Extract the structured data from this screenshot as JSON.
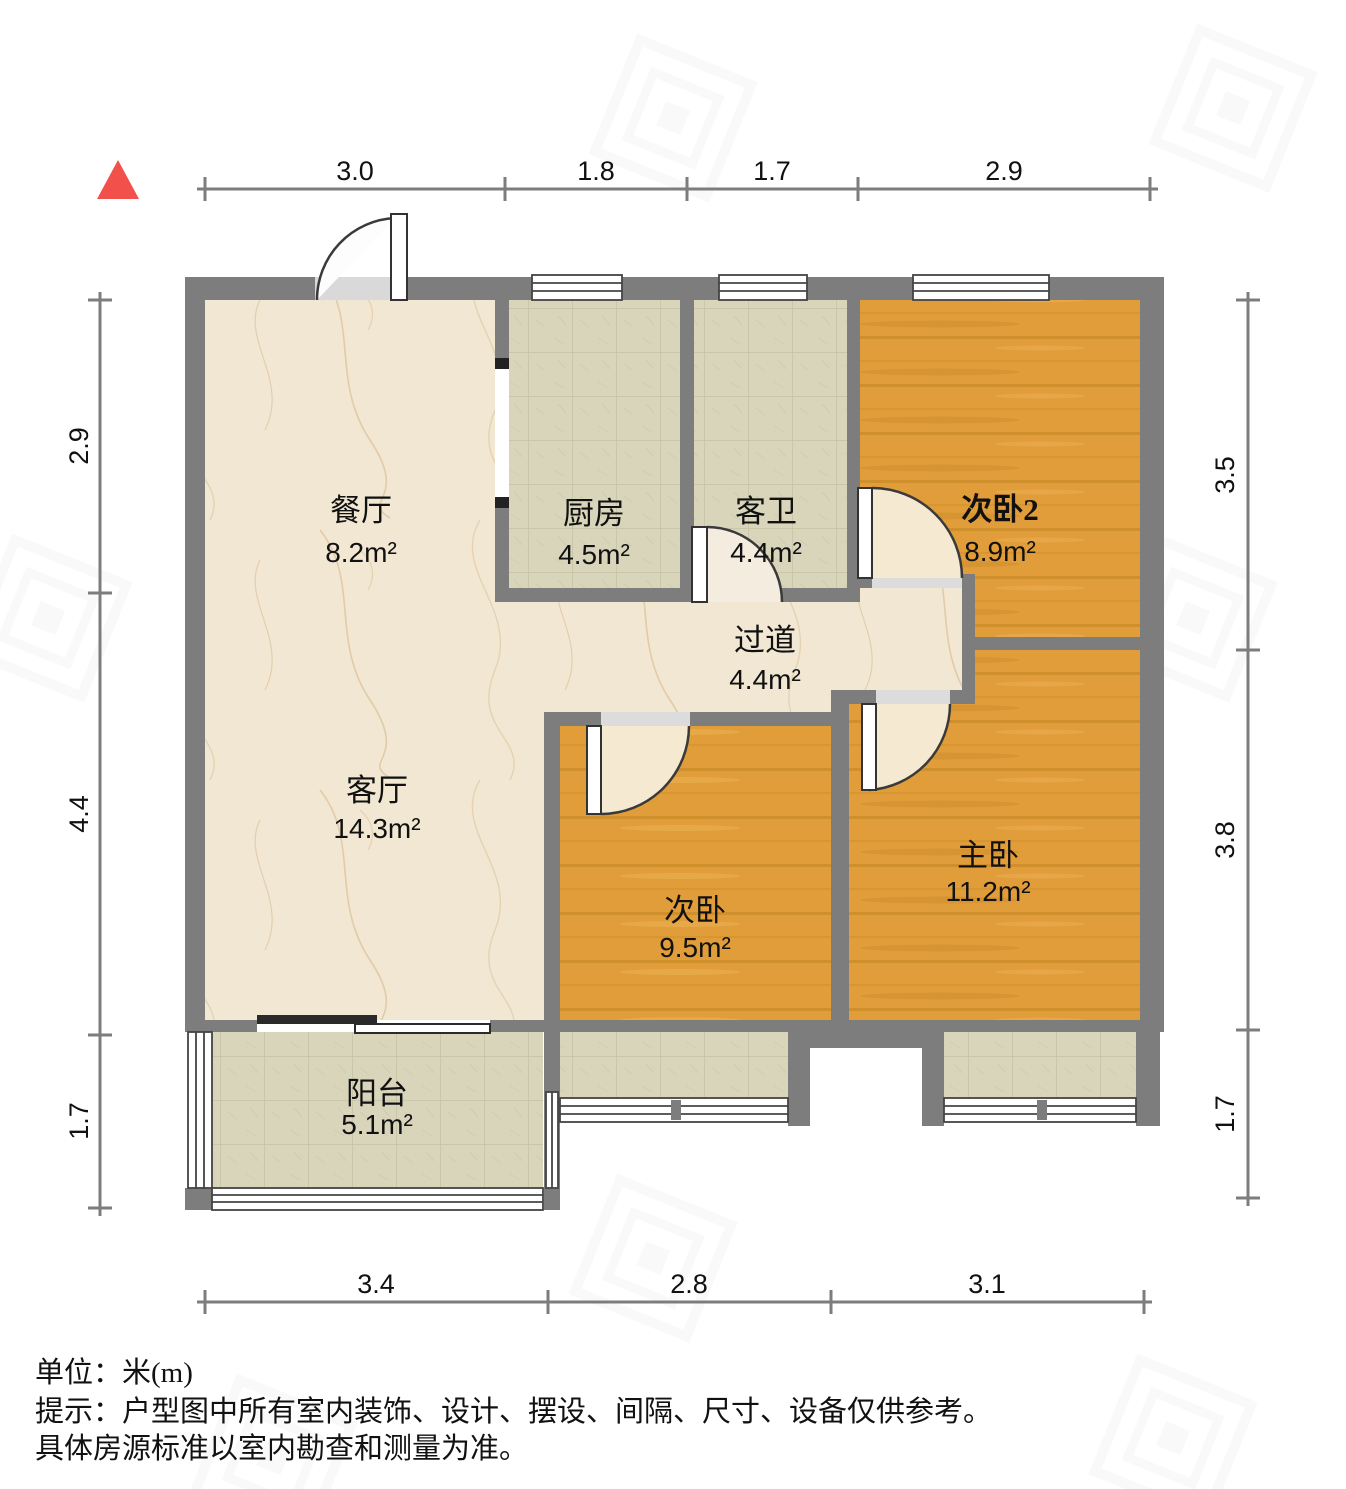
{
  "title": "户型图",
  "north_indicator": "north-triangle",
  "dimensions": {
    "top": [
      "3.0",
      "1.8",
      "1.7",
      "2.9"
    ],
    "left": [
      "2.9",
      "4.4",
      "1.7"
    ],
    "right": [
      "3.5",
      "3.8",
      "1.7"
    ],
    "bottom": [
      "3.4",
      "2.8",
      "3.1"
    ]
  },
  "rooms": [
    {
      "id": "dining",
      "name": "餐厅",
      "area": "8.2m²"
    },
    {
      "id": "kitchen",
      "name": "厨房",
      "area": "4.5m²"
    },
    {
      "id": "guest-bath",
      "name": "客卫",
      "area": "4.4m²"
    },
    {
      "id": "bedroom2",
      "name": "次卧2",
      "area": "8.9m²"
    },
    {
      "id": "corridor",
      "name": "过道",
      "area": "4.4m²"
    },
    {
      "id": "living",
      "name": "客厅",
      "area": "14.3m²"
    },
    {
      "id": "bedroom",
      "name": "次卧",
      "area": "9.5m²"
    },
    {
      "id": "master",
      "name": "主卧",
      "area": "11.2m²"
    },
    {
      "id": "balcony",
      "name": "阳台",
      "area": "5.1m²"
    }
  ],
  "footer": {
    "line1": "单位：米(m)",
    "line2": "提示：户型图中所有室内装饰、设计、摆设、间隔、尺寸、设备仅供参考。",
    "line3": "具体房源标准以室内勘查和测量为准。"
  },
  "colors": {
    "wall": "#7d7d7d",
    "wood_floor": "#e19d3a",
    "marble_floor": "#f1e7d2",
    "tile_floor": "#d8d5bb",
    "north_arrow": "#f2504b"
  }
}
